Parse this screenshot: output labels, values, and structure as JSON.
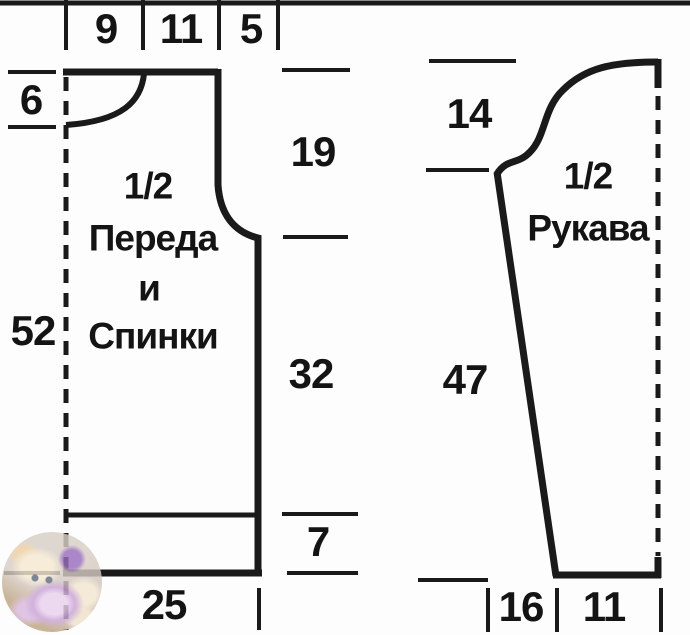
{
  "colors": {
    "line": "#1a1a1a",
    "background": "#fdfdfd",
    "text": "#141414"
  },
  "front_back": {
    "title_lines": [
      "1/2",
      "Переда",
      "и",
      "Спинки"
    ],
    "top_widths": [
      "9",
      "11",
      "5"
    ],
    "neck_depth": "6",
    "total_length": "52",
    "armhole_depth": "19",
    "side_to_underarm": "32",
    "hem_band_height": "7",
    "half_width": "25"
  },
  "sleeve": {
    "title_lines": [
      "1/2",
      "Рукава"
    ],
    "cap_height": "14",
    "seam_length": "47",
    "bottom_offset": "16",
    "half_cuff_width": "11"
  },
  "watermark": {
    "icon": "kitten-yarn-photo"
  }
}
